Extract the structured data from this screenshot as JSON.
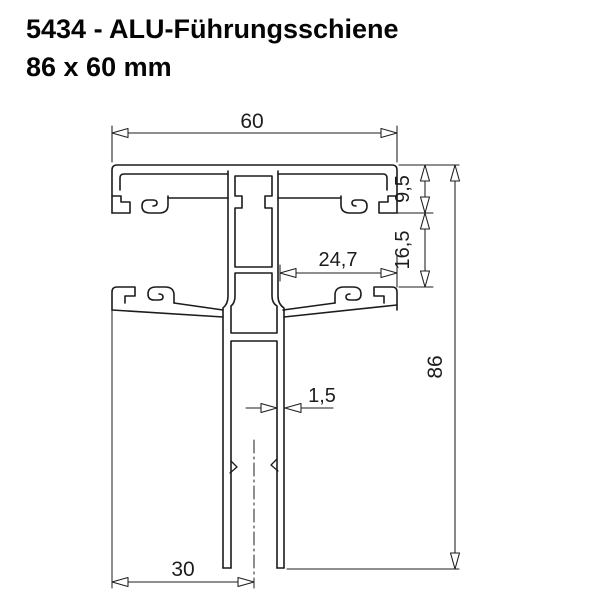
{
  "page": {
    "background": "#ffffff"
  },
  "title": {
    "line1": "5434 - ALU-Führungsschiene",
    "line2": "86 x 60 mm"
  },
  "drawing": {
    "description": "Cross-section technical drawing of an aluminium roller-shutter guide rail profile",
    "line_color": "#1c1c1c",
    "background": "#ffffff",
    "dimensions": {
      "top_width": "60",
      "first_channel_depth": "9,5",
      "second_channel_offset": "16,5",
      "pocket_width": "24,7",
      "total_depth": "86",
      "wall_thickness": "1,5",
      "guide_center_offset": "30"
    }
  }
}
